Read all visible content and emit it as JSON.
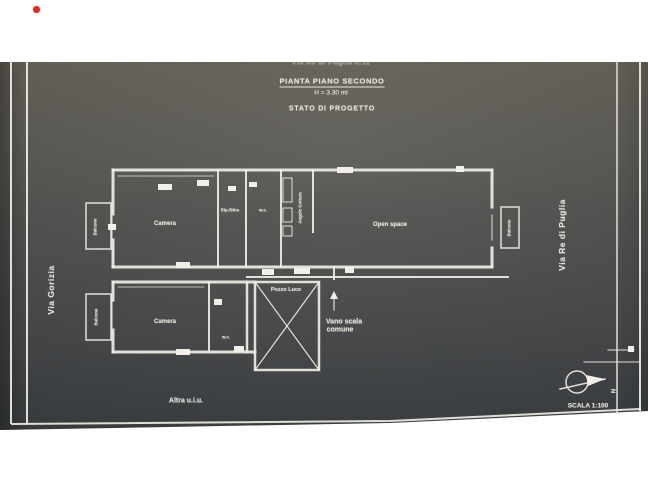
{
  "header": {
    "address_line": "Via Re di Puglia n.11",
    "title": "PIANTA PIANO SECONDO",
    "height_note": "H = 3.30 ml",
    "status": "STATO DI PROGETTO"
  },
  "streets": {
    "left": "Via Gorizia",
    "right": "Via Re di Puglia"
  },
  "rooms": {
    "camera_top": "Camera",
    "rip_stira": "Rip./Stira",
    "wc_top": "w.c.",
    "angolo_cottura": "Angolo Cottura",
    "open_space": "Open space",
    "balcone_top_left": "Balcone",
    "balcone_bottom_left": "Balcone",
    "balcone_right": "Balcone",
    "camera_bottom": "Camera",
    "wc_bottom": "w.c.",
    "pozzo_luce": "Pozzo Luce",
    "vano_scala_line1": "Vano scala",
    "vano_scala_line2": "comune",
    "altra_uiu": "Altra u.i.u."
  },
  "titleblock": {
    "scale": "SCALA 1:100",
    "north_letter": "N"
  },
  "colors": {
    "line": "#f2efe8",
    "marker_red": "#dd2c1d",
    "photo_dark": "#393d40"
  }
}
